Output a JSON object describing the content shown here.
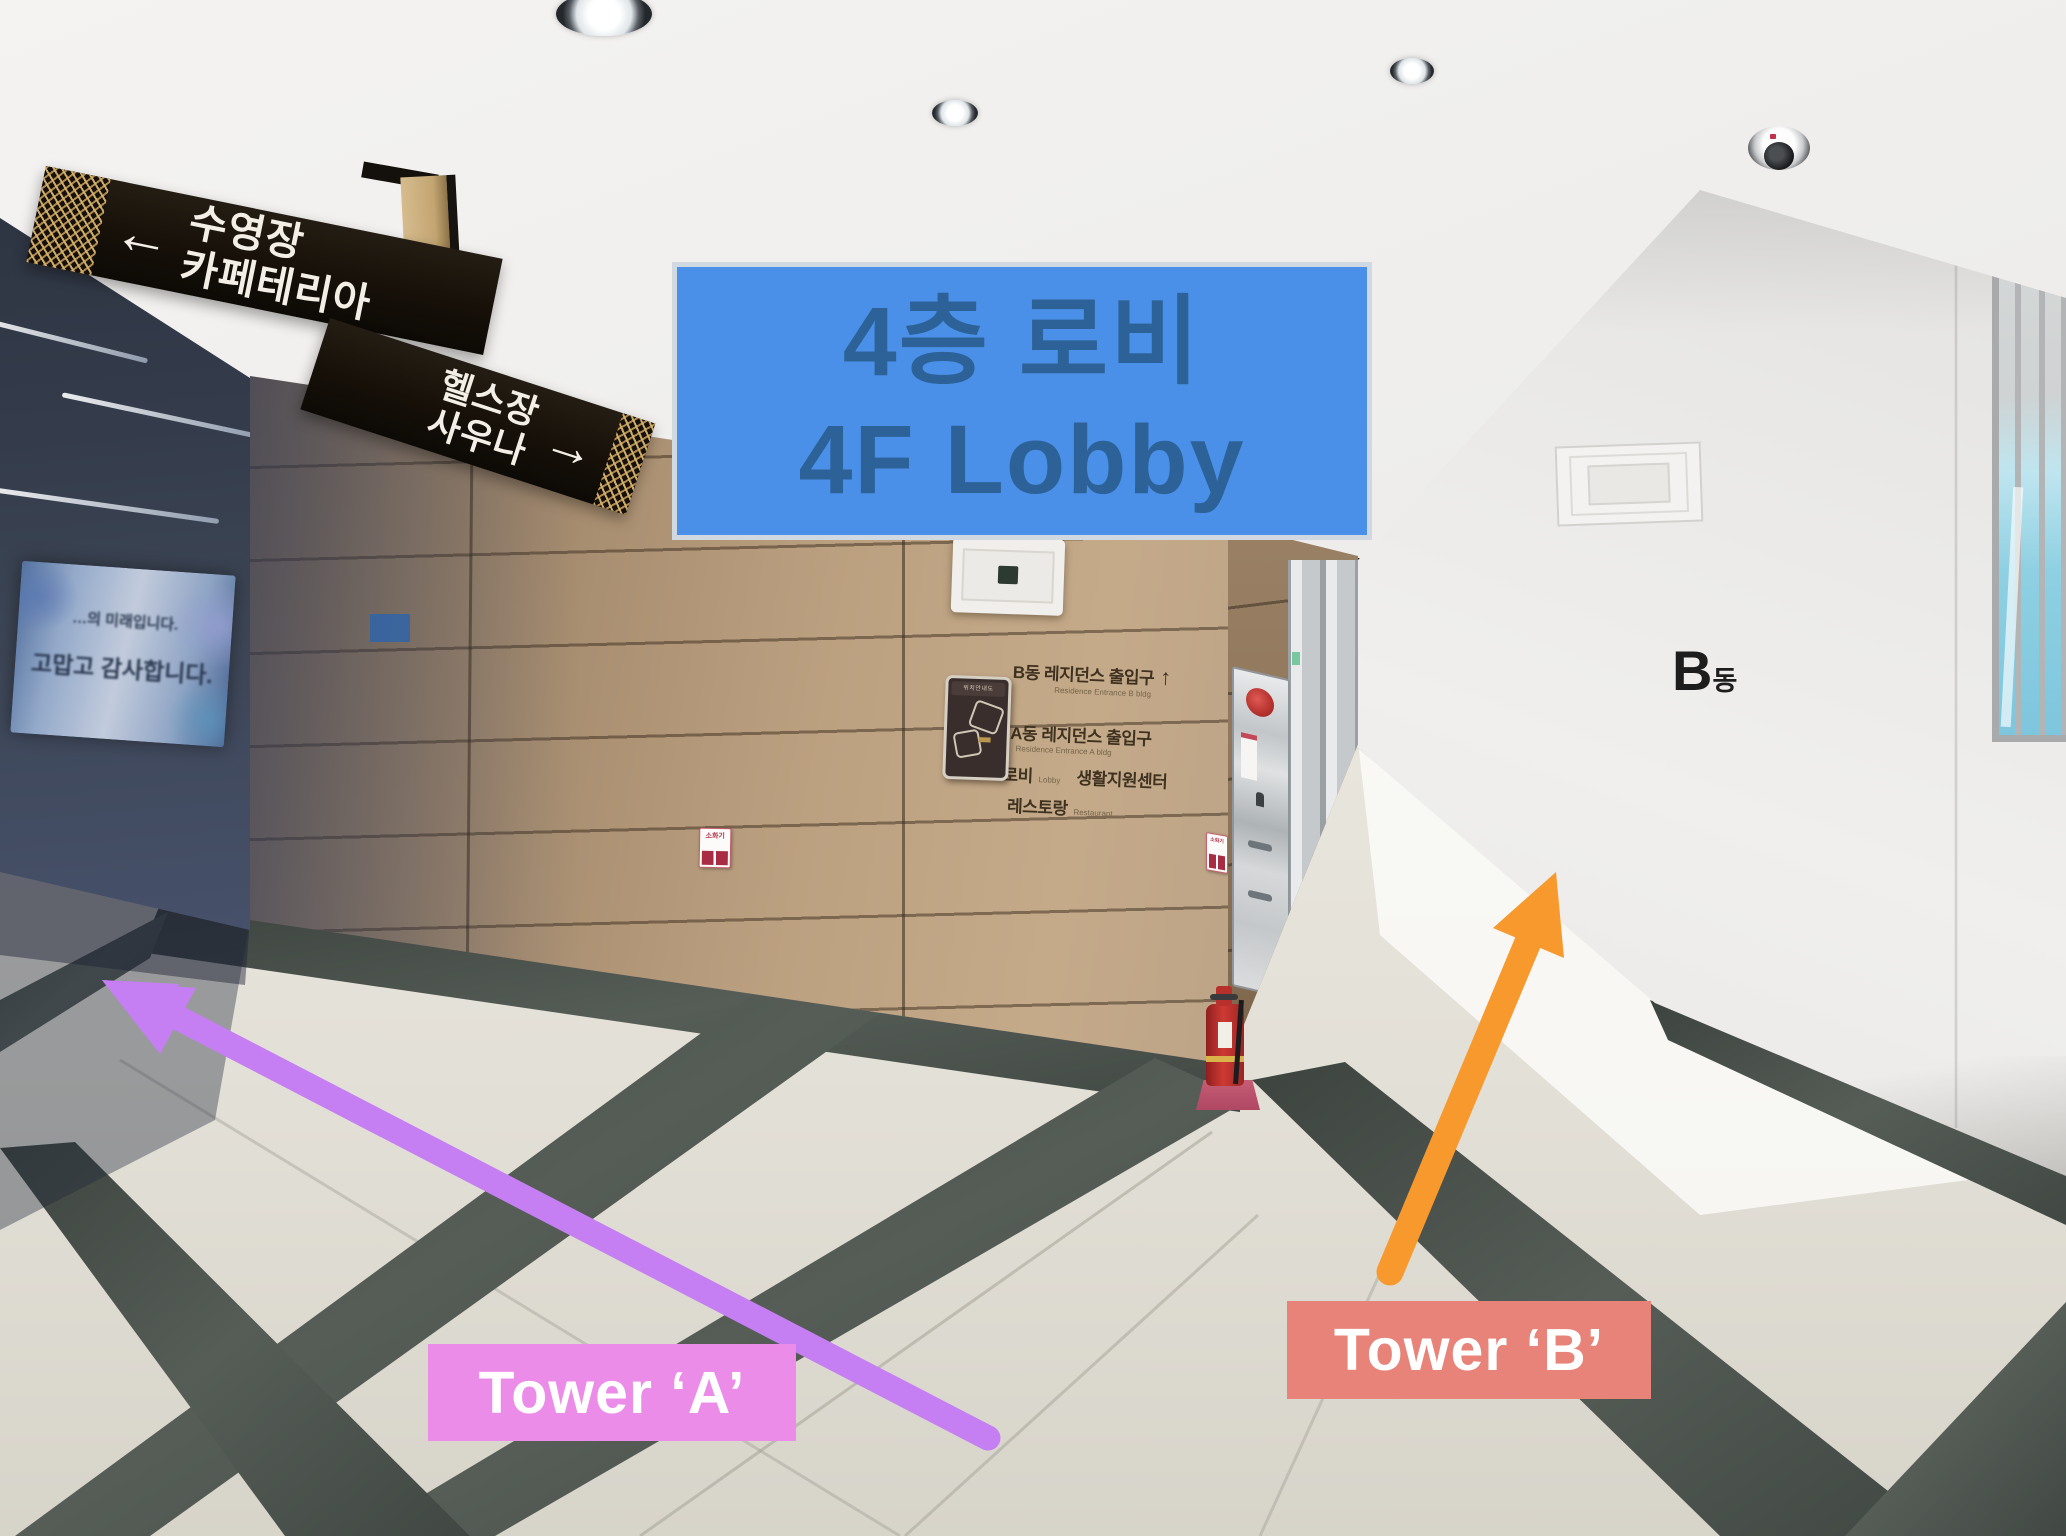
{
  "overlay": {
    "lobby_box": {
      "line_ko": "4층 로비",
      "line_en": "4F Lobby"
    },
    "tower_a_label": "Tower ‘A’",
    "tower_b_label": "Tower ‘B’",
    "colors": {
      "lobby_box_bg": "#4a90e8",
      "lobby_box_text": "#2d6298",
      "tower_a_bg": "#ec8ce9",
      "tower_b_bg": "#e8837a",
      "arrow_purple": "#c57ff2",
      "arrow_orange": "#f8992e"
    }
  },
  "hanging_sign": {
    "left_arrow": "←",
    "pool": "수영장",
    "cafeteria": "카페테리아",
    "gym": "헬스장",
    "sauna": "사우나",
    "right_arrow": "→"
  },
  "wall_sign": {
    "b_ko": "B동 레지던스 출입구",
    "b_en": "Residence Entrance B bldg",
    "up_arrow": "↑",
    "a_ko": "A동 레지던스 출입구",
    "a_en": "Residence Entrance A bldg",
    "left_arrow": "←",
    "lobby_ko": "로비",
    "lobby_en": "Lobby",
    "support_ko": "생활지원센터",
    "restaurant_ko": "레스토랑",
    "restaurant_en": "Restaurant"
  },
  "map_plaque": {
    "title": "위치안내도"
  },
  "b_wing": {
    "big": "B",
    "small": "동"
  },
  "info_desk": {
    "label": "INFORMATION"
  },
  "banner": {
    "line1": "…의 미래입니다.",
    "line2": "고맙고 감사합니다."
  },
  "stickers": {
    "fire_extinguisher": "소화기"
  }
}
